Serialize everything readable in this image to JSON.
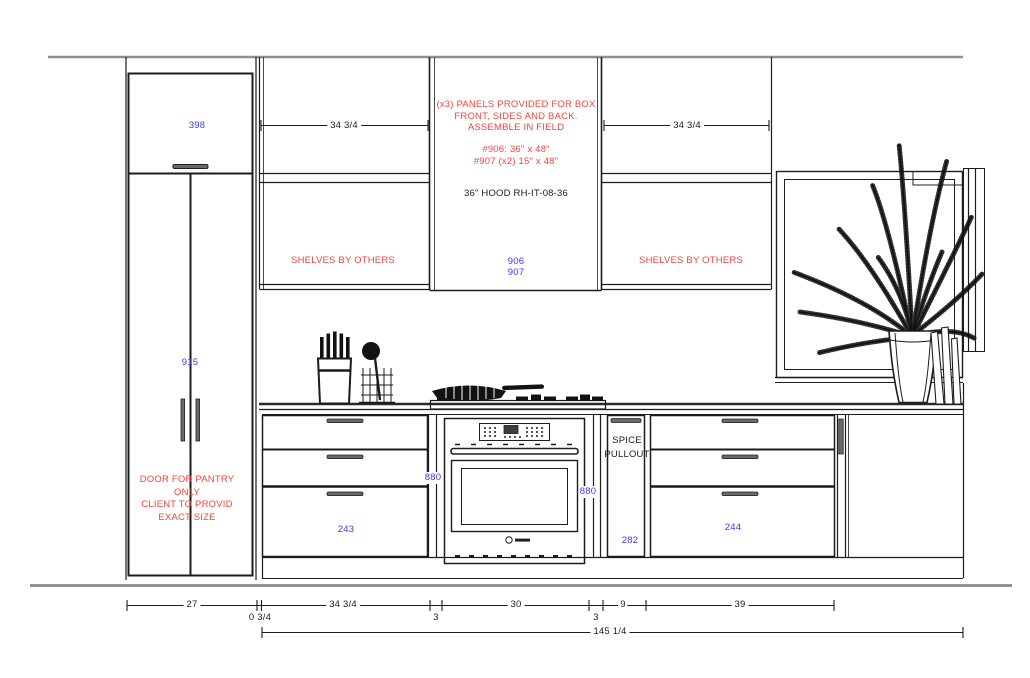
{
  "drawing_type": "kitchen elevation CAD drawing",
  "colors": {
    "line": "#1c1c1c",
    "soft_line": "#8f8f8f",
    "blue_code": "#3a3aef",
    "red_note": "#f2453d"
  },
  "labels": {
    "pantry_upper_code": "398",
    "pantry_tall_code": "915",
    "pantry_note": "DOOR FOR PANTRY\nONLY\nCLIENT TO PROVID\nEXACT SIZE",
    "shelf_left_width": "34 3/4",
    "shelf_right_width": "34 3/4",
    "shelves_by_others_left": "SHELVES BY OTHERS",
    "shelves_by_others_right": "SHELVES BY OTHERS",
    "panels_note": "(x3) PANELS PROVIDED FOR BOX\nFRONT, SIDES AND BACK.\nASSEMBLE IN FIELD",
    "panel_sizes": "#906: 36\" x 48\"\n#907 (x2) 15\" x 48\"",
    "hood_model": "36\" HOOD RH-IT-08-36",
    "hood_panel_codes": "906\n907",
    "base_left_code": "243",
    "oven_left_code": "880",
    "oven_right_code": "880",
    "spice_pullout_label": "SPICE\nPULLOUT",
    "spice_code": "282",
    "base_right_code": "244"
  },
  "dimensions": {
    "bottom_row": [
      "27",
      "0 3/4",
      "34 3/4",
      "3",
      "30",
      "3",
      "9",
      "39"
    ],
    "overall": "145 1/4"
  }
}
